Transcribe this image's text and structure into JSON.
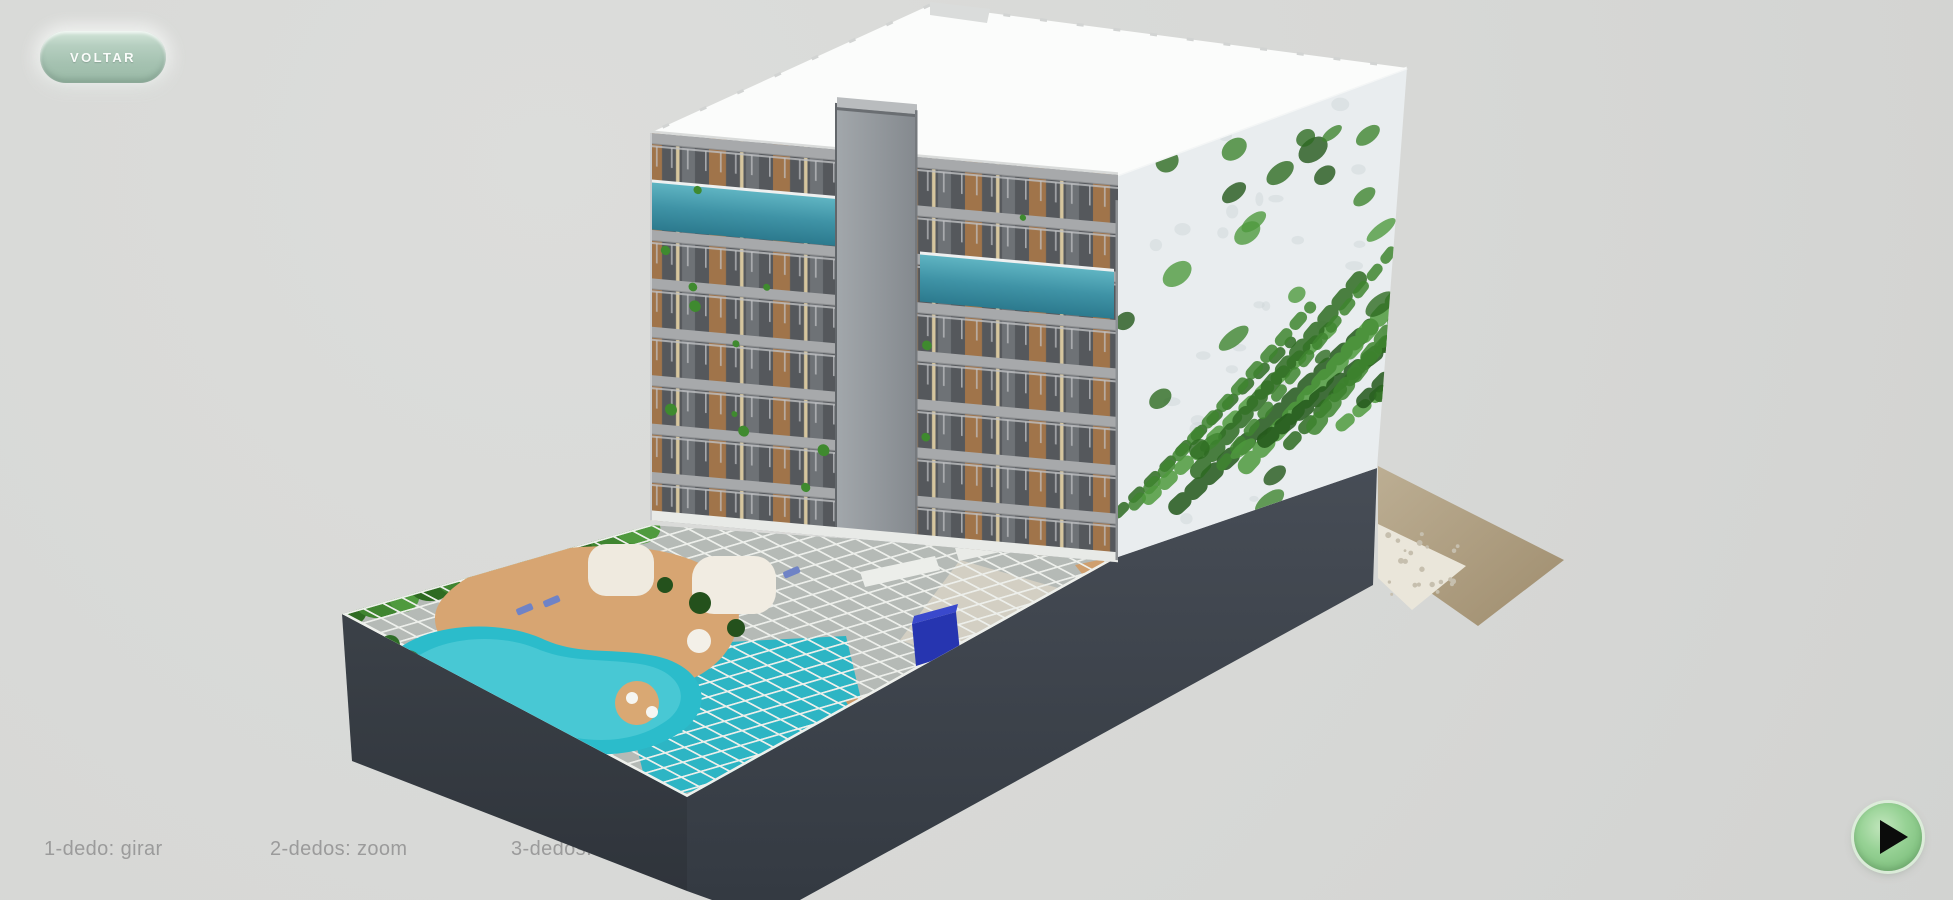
{
  "back_button": {
    "label": "VOLTAR"
  },
  "gesture_hints": [
    {
      "label": "1-dedo: girar"
    },
    {
      "label": "2-dedos: zoom"
    },
    {
      "label": "3-dedos: mover"
    }
  ],
  "player": {
    "icon": "play-triangle"
  },
  "colors": {
    "background": "#d7d8d6",
    "back_button_mint": "#a5c2b1",
    "back_button_text": "#fafcfa",
    "hint_text": "#9b9b9b",
    "play_button_green": "#8fcd8d",
    "play_glyph": "#0b0c0b",
    "roof_white": "#fbfcfb",
    "podium_dark": "#41464e",
    "green_wall_ivy": "#3f8530",
    "facade_wood": "#a0744a",
    "facade_slab_gray": "#a7a9ab",
    "lap_pool_teal": "#3f93a6",
    "deck_pool_turquoise": "#2bbccb",
    "deck_sand": "#d7a572",
    "terrain_tan": "#b3a489"
  }
}
